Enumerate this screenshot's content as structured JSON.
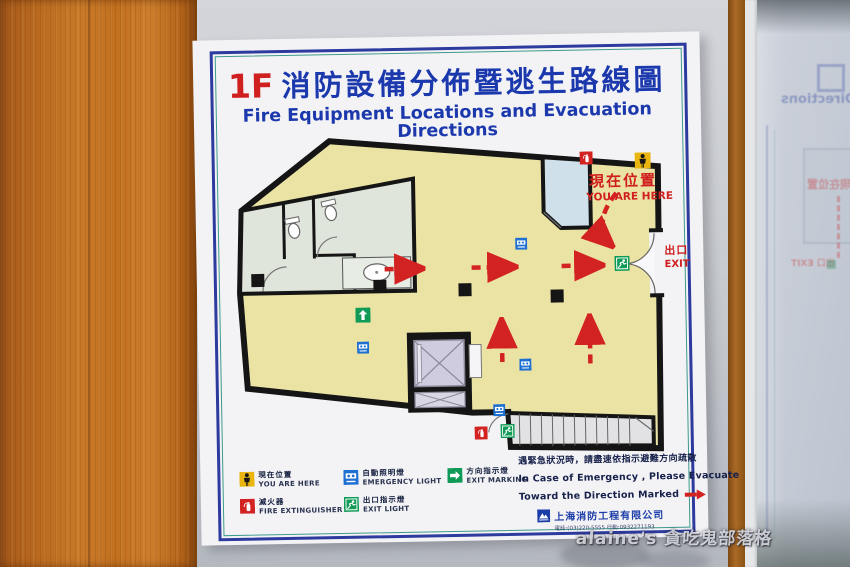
{
  "sign": {
    "floor": "1F",
    "title_zh": "消防設備分佈暨逃生路線圖",
    "title_en": "Fire Equipment Locations and Evacuation Directions",
    "map": {
      "you_are_here_zh": "現在位置",
      "you_are_here_en": "YOU ARE HERE",
      "exit_zh": "出口",
      "exit_en": "EXIT"
    },
    "legend": {
      "items": [
        {
          "zh": "現在位置",
          "en": "YOU ARE HERE",
          "icon": "you-are-here"
        },
        {
          "zh": "自動照明燈",
          "en": "EMERGENCY LIGHT",
          "icon": "emergency-light"
        },
        {
          "zh": "方向指示燈",
          "en": "EXIT MARKING",
          "icon": "exit-marking"
        },
        {
          "zh": "滅火器",
          "en": "FIRE EXTINGUISHER",
          "icon": "fire-extinguisher"
        },
        {
          "zh": "出口指示燈",
          "en": "EXIT LIGHT",
          "icon": "exit-light"
        }
      ]
    },
    "notice": {
      "zh": "遇緊急狀況時，請盡速依指示避難方向疏散",
      "en_line1": "In Case of Emergency , Please Evacuate",
      "en_line2": "Toward the Direction Marked",
      "company": "上海消防工程有限公司",
      "phone": "電話:(03)220-5555  行動:0932271193"
    },
    "colors": {
      "title_blue": "#1b38ad",
      "accent_red": "#d01f1f",
      "floor_yellow": "#ebe3a3",
      "legend_yellow": "#e9b50e",
      "legend_blue": "#1e6fd2",
      "legend_green": "#0f9a55"
    }
  },
  "reflection": {
    "title_tail": "Directions",
    "you_are_here": "現在位置",
    "exit": "出口 EXIT"
  },
  "watermark": "alaine's 貪吃鬼部落格"
}
